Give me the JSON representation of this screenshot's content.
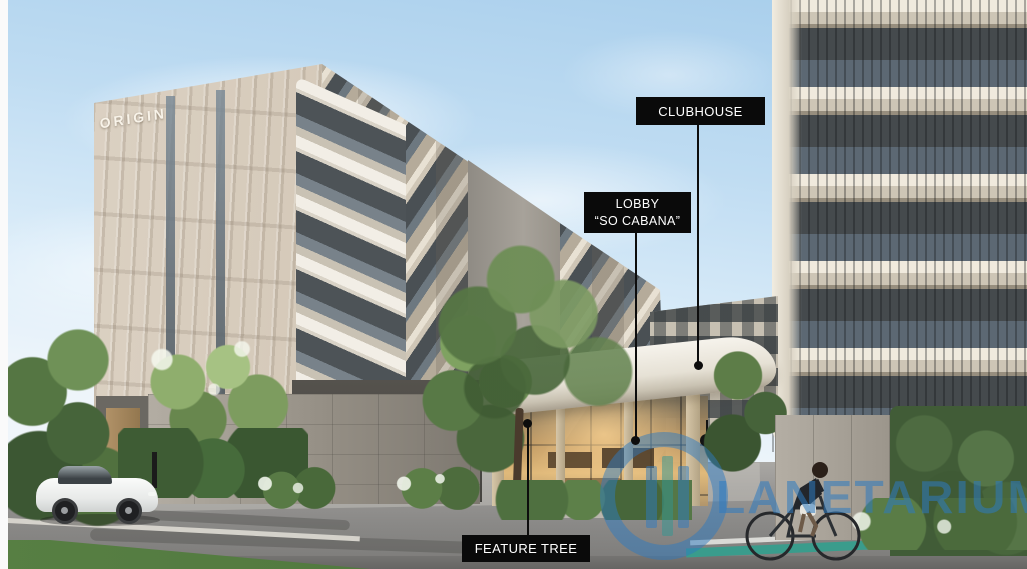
{
  "signage": {
    "origin": "ORIGIN",
    "entrance_logo": "SO"
  },
  "annotations": {
    "clubhouse": "CLUBHOUSE",
    "lobby_line1": "LOBBY",
    "lobby_line2": "“SO CABANA”",
    "feature_tree": "FEATURE TREE"
  },
  "watermark": {
    "brand": "PLANETARIUM",
    "visible_text": "LANETARIUM"
  },
  "palette": {
    "label_background": "#0a0a0a",
    "label_text": "#ffffff",
    "watermark_blue": "#2d7ac0",
    "logo_gold": "#c2a15e",
    "bike_lane_teal": "#3a9c8c",
    "sky_blue": "#a6cdeb",
    "building_cream": "#d3c8ba"
  }
}
